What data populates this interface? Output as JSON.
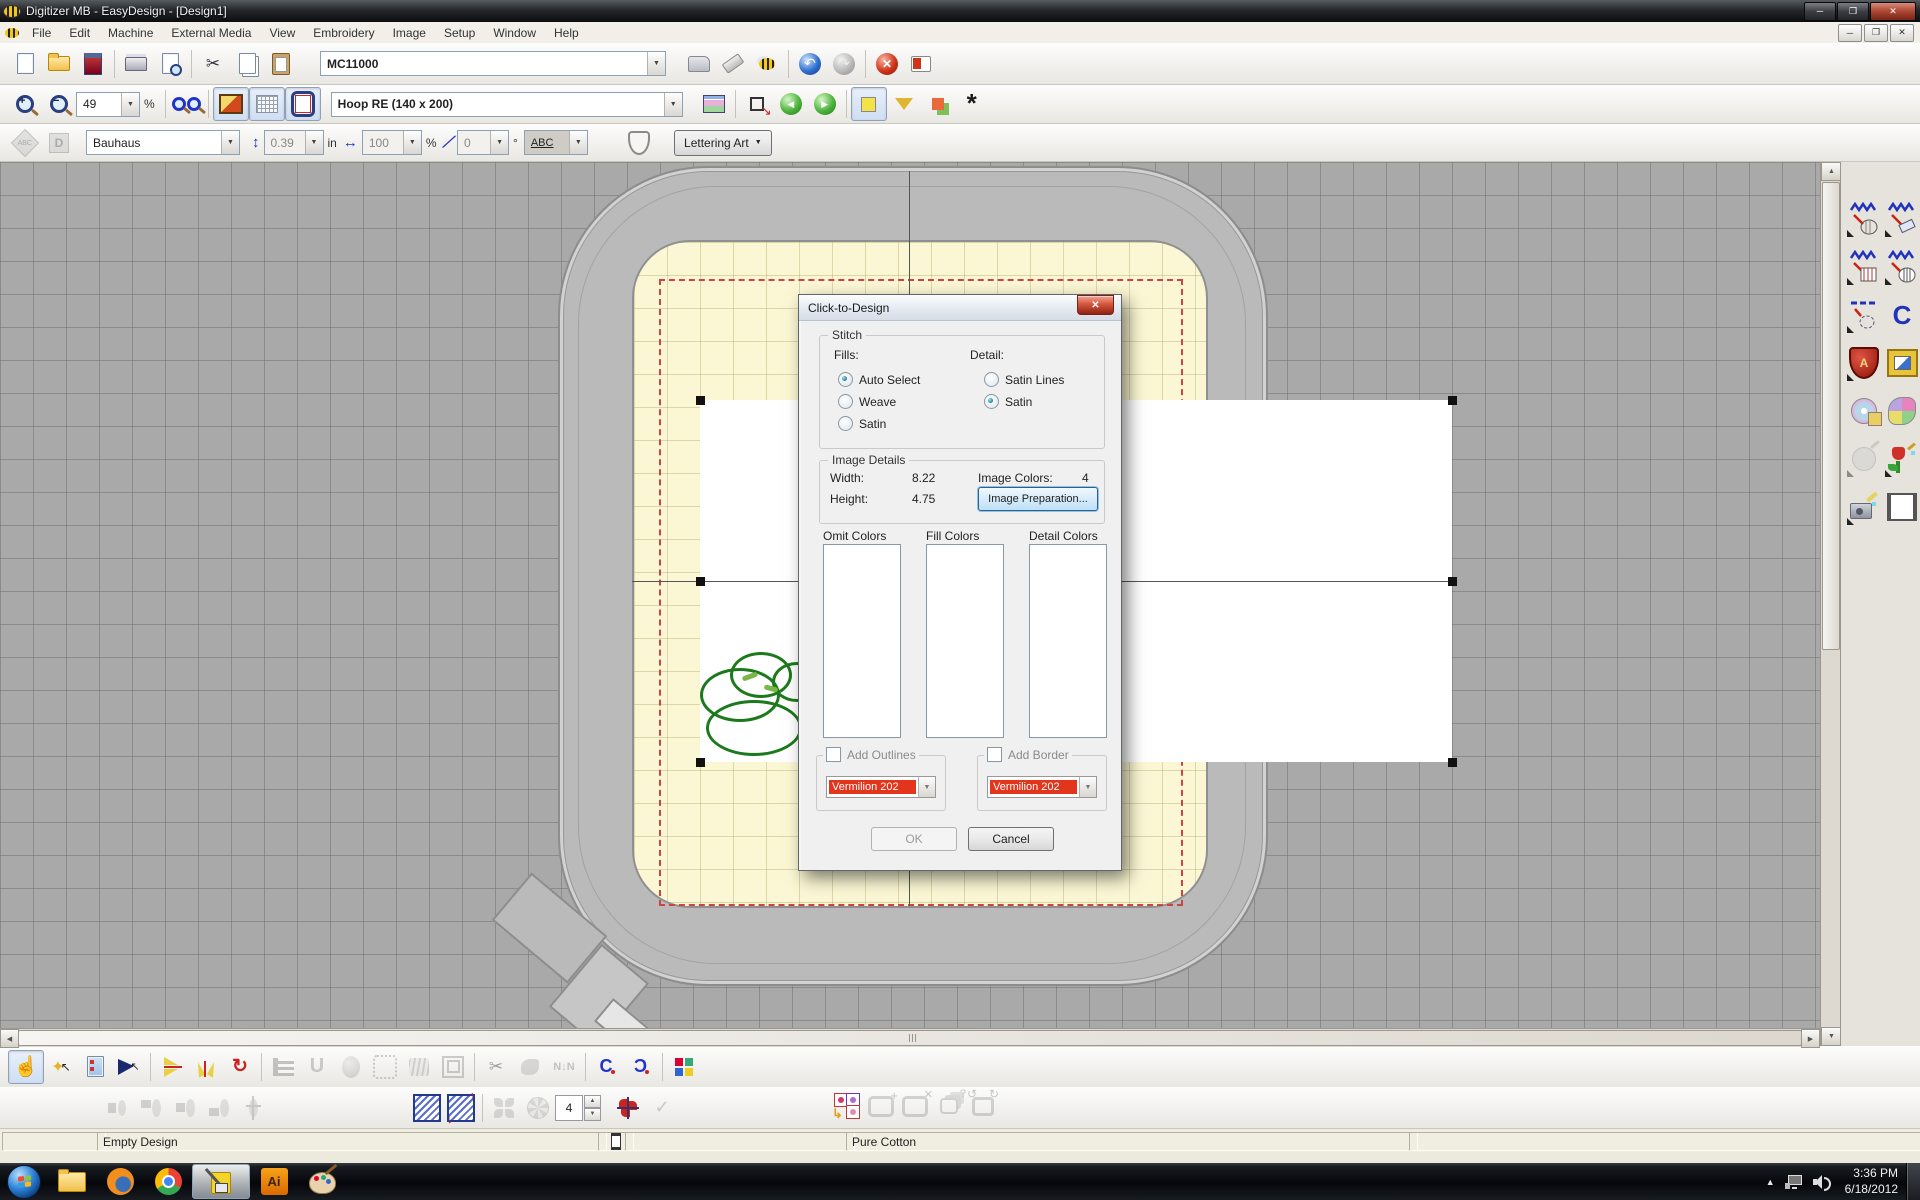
{
  "window": {
    "title": "Digitizer MB - EasyDesign - [Design1]",
    "controls": [
      "minimize",
      "maximize",
      "close"
    ]
  },
  "menu_bar": {
    "items": [
      {
        "label": "File"
      },
      {
        "label": "Edit"
      },
      {
        "label": "Machine"
      },
      {
        "label": "External Media"
      },
      {
        "label": "View"
      },
      {
        "label": "Embroidery"
      },
      {
        "label": "Image"
      },
      {
        "label": "Setup"
      },
      {
        "label": "Window"
      },
      {
        "label": "Help"
      }
    ]
  },
  "toolbar_main": {
    "icon_names": [
      "new",
      "open",
      "write-to-machine",
      "print",
      "print-preview",
      "cut",
      "copy",
      "paste",
      "sewing-machine",
      "stitch-eraser",
      "bee",
      "undo",
      "redo",
      "stop",
      "design-info"
    ],
    "machine_select": {
      "value": "MC11000"
    }
  },
  "toolbar_view": {
    "icon_names": [
      "zoom-in",
      "zoom-out",
      "overview",
      "backdrop-toggle",
      "grid-toggle",
      "hoop-toggle",
      "overview-window",
      "send-to-view",
      "back",
      "forward",
      "show-objects-toggle",
      "funnel",
      "color-clone",
      "flower"
    ],
    "zoom_value": "49",
    "zoom_unit": "%",
    "hoop_select": {
      "value": "Hoop RE (140 x 200)"
    }
  },
  "toolbar_lettering": {
    "icon_names": [
      "monogram-abc",
      "monogram-d",
      "letter-height",
      "letter-width",
      "letter-slant",
      "baseline",
      "shield"
    ],
    "font_select": "Bauhaus",
    "height_value": "0.39",
    "height_unit": "in",
    "width_value": "100",
    "width_unit": "%",
    "angle_value": "0",
    "angle_unit": "°",
    "baseline_value": "ABC",
    "lettering_menu_label": "Lettering Art"
  },
  "toolbox_right": {
    "icon_names": [
      "fill-stitch-shape",
      "fill-stitch-ribbon",
      "weave-fill",
      "satin-fill",
      "outline-stitch",
      "monogram-c",
      "lettering-shield",
      "picture-frame",
      "clipart-cd",
      "flower-patch",
      "auto-digitize",
      "color-photo-stitch",
      "photo-stitch",
      "frame-outline"
    ]
  },
  "dialog": {
    "title": "Click-to-Design",
    "stitch_group": {
      "label": "Stitch",
      "fills_label": "Fills:",
      "fills_options": [
        {
          "label": "Auto Select",
          "selected": true
        },
        {
          "label": "Weave",
          "selected": false
        },
        {
          "label": "Satin",
          "selected": false
        }
      ],
      "detail_label": "Detail:",
      "detail_options": [
        {
          "label": "Satin Lines",
          "selected": false
        },
        {
          "label": "Satin",
          "selected": true
        }
      ]
    },
    "image_details_group": {
      "label": "Image Details",
      "width_label": "Width:",
      "width_value": "8.22",
      "height_label": "Height:",
      "height_value": "4.75",
      "image_colors_label": "Image Colors:",
      "image_colors_value": "4",
      "image_preparation_button": "Image Preparation..."
    },
    "color_lists": {
      "omit_label": "Omit Colors",
      "fill_label": "Fill Colors",
      "detail_label": "Detail Colors"
    },
    "add_outlines": {
      "label": "Add Outlines",
      "checked": false,
      "color_value": "Vermilion 202",
      "color_hex": "#e2351b"
    },
    "add_border": {
      "label": "Add Border",
      "checked": false,
      "color_value": "Vermilion 202",
      "color_hex": "#e2351b"
    },
    "ok_button": "OK",
    "cancel_button": "Cancel"
  },
  "bottom_toolbar": {
    "row1_icon_names": [
      "select",
      "magic-wand-select",
      "object-properties",
      "reshape",
      "flip-vertical",
      "mirror-fan",
      "rotate",
      "comb-fill",
      "turning-fill",
      "circle-fill",
      "stipple-fill",
      "contour-fill",
      "spiral-fill",
      "trim",
      "texture",
      "closest-join",
      "curve-clockwise",
      "curve-counterclockwise",
      "thread-colors"
    ],
    "row2_icon_names": [
      "align-left",
      "align-center-vertical",
      "align-center",
      "align-bottom",
      "align-middle",
      "hatch-fill",
      "hatch-direction",
      "wreath",
      "kaleidoscope",
      "kaleidoscope-axis",
      "apply-check",
      "color-film",
      "add-hoop",
      "delete-hoop",
      "hoop-sequence",
      "rotate-hoop"
    ],
    "repeat_count": "4"
  },
  "status_bar": {
    "design_status": "Empty Design",
    "fabric": "Pure Cotton"
  },
  "taskbar": {
    "app_names": [
      "start",
      "explorer",
      "firefox",
      "chrome",
      "digitizer-active",
      "illustrator",
      "paint"
    ],
    "clock_time": "3:36 PM",
    "clock_date": "6/18/2012"
  },
  "colors": {
    "canvas_bg": "#a9a9a9",
    "hoop_ring": "#bababa",
    "hoop_inner": "#fbf7d4",
    "guide_red": "#cc4433",
    "vermilion": "#e2351b"
  }
}
